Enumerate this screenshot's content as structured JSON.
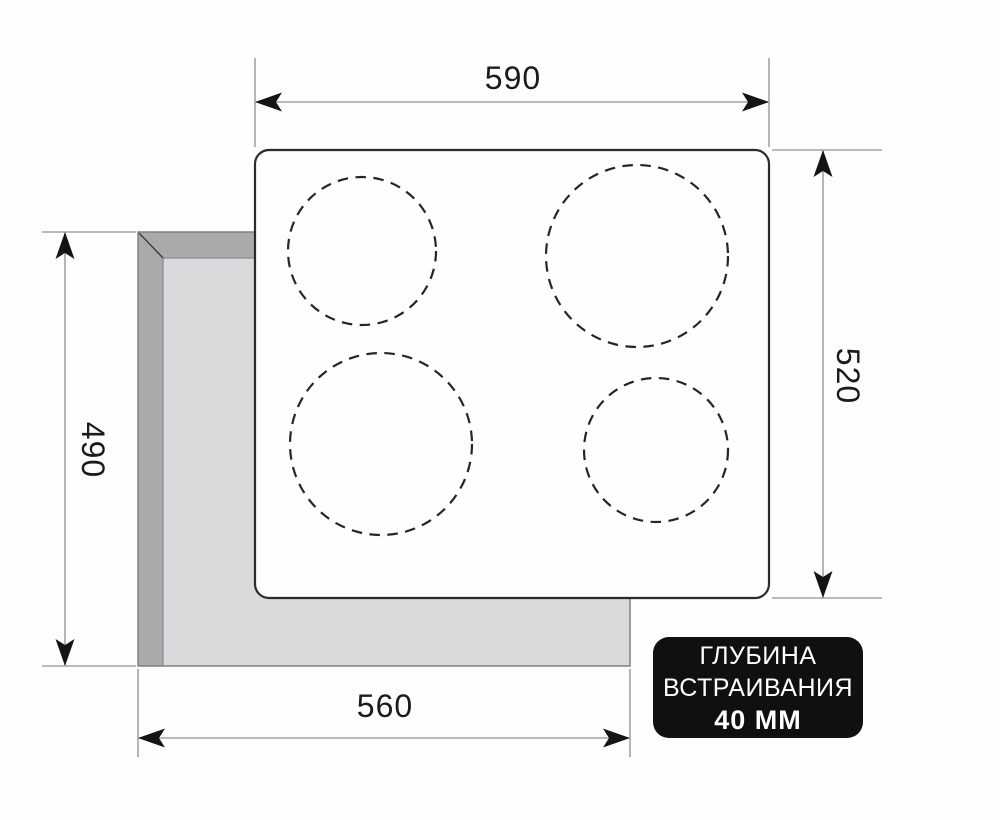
{
  "dimensions": {
    "top_width": "590",
    "right_height": "520",
    "left_height": "490",
    "bottom_width": "560"
  },
  "badge": {
    "line1": "ГЛУБИНА",
    "line2": "ВСТРАИВАНИЯ",
    "line3": "40 ММ"
  },
  "cooktop": {
    "burner_count": 4
  },
  "colors": {
    "badge_bg": "#101010",
    "badge_text": "#ffffff",
    "cutout_light": "#d9dadb",
    "cutout_dark": "#a8aaac",
    "dimension_line_gray": "#a4a4a4",
    "drawing_black": "#141414",
    "background": "#fdfdfe"
  }
}
